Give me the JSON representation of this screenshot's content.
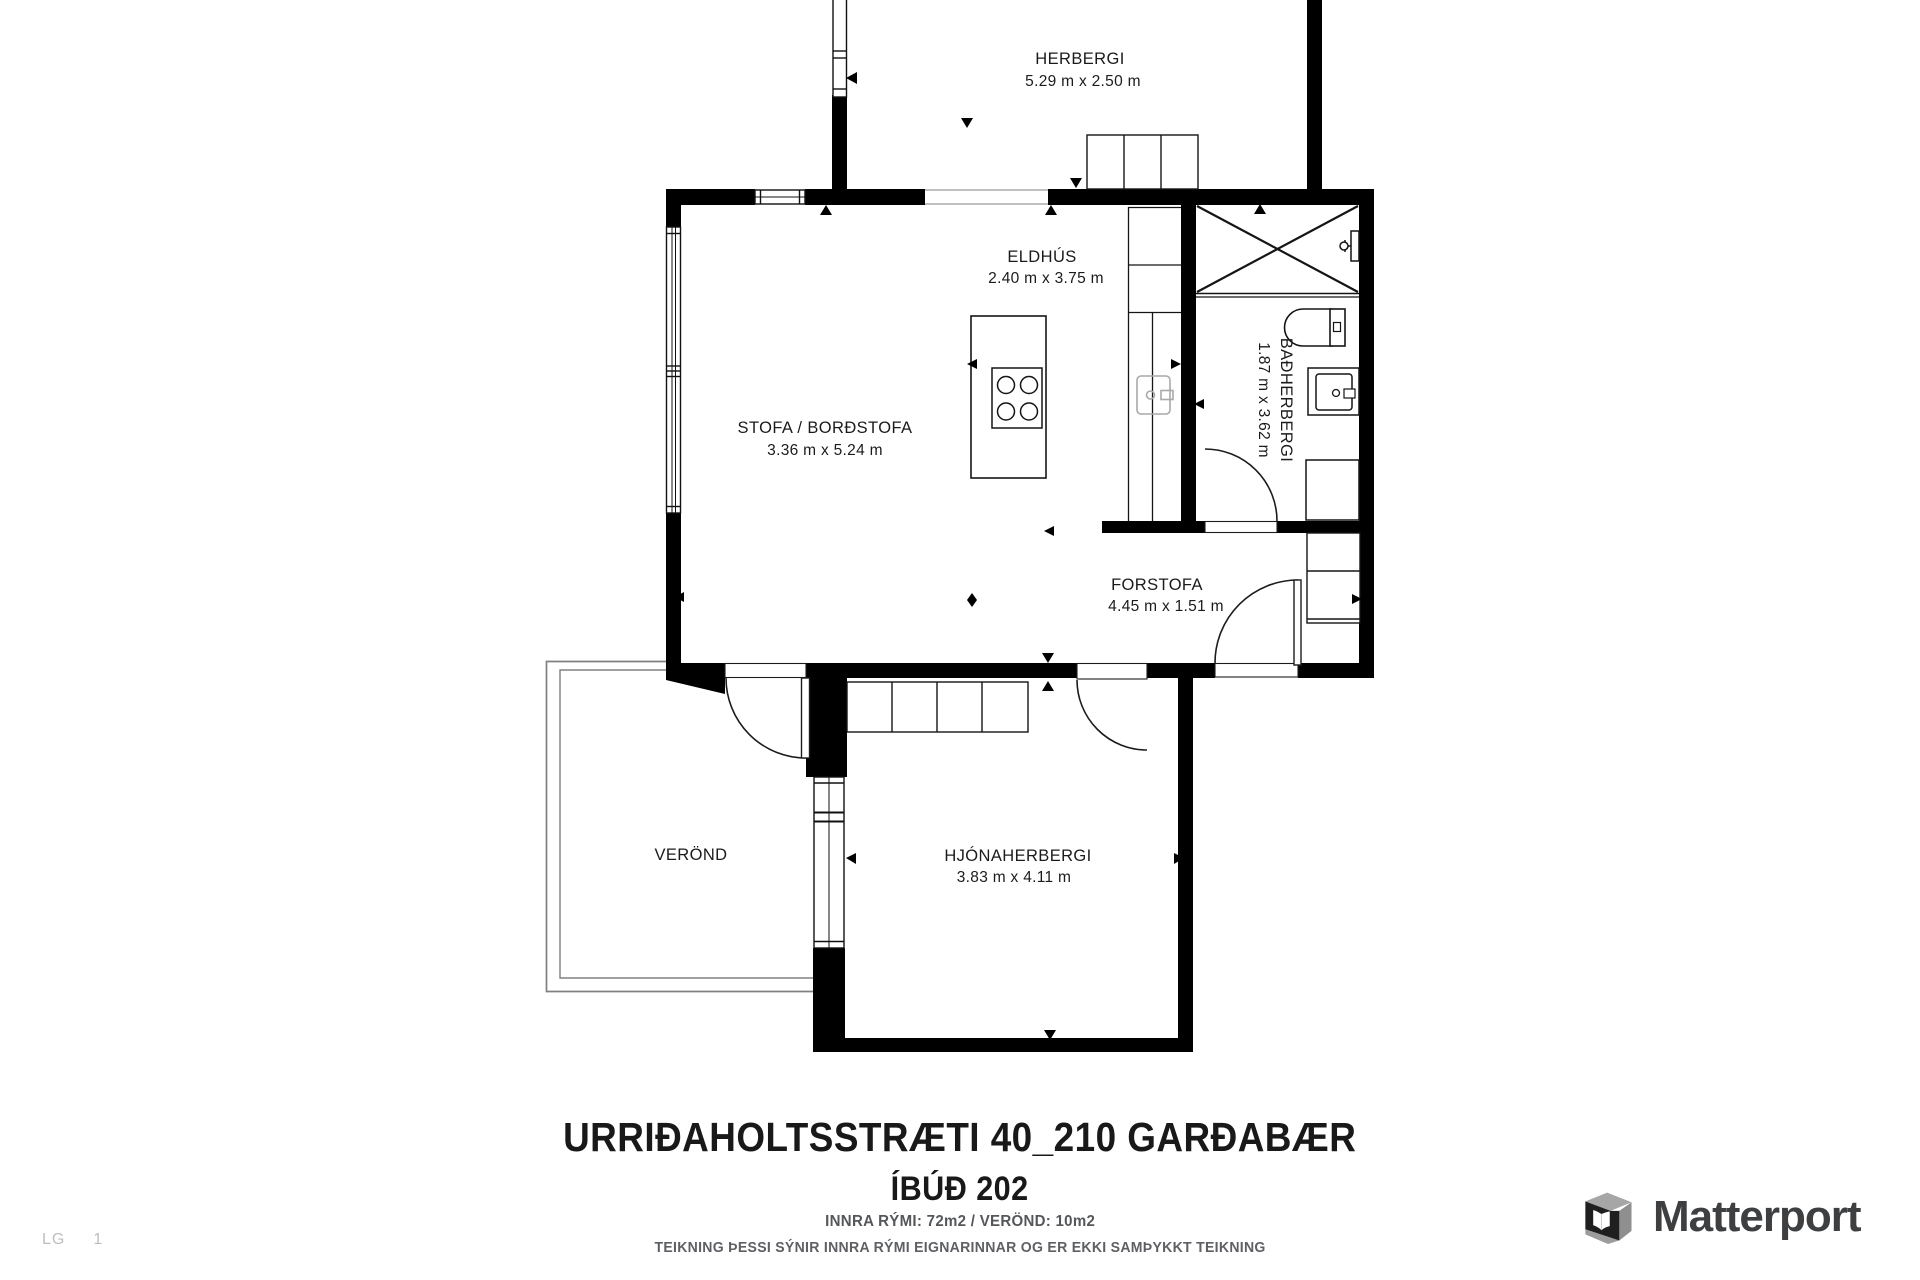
{
  "rooms": {
    "herbergi": {
      "name": "HERBERGI",
      "dims": "5.29 m x 2.50 m"
    },
    "eldhus": {
      "name": "ELDHÚS",
      "dims": "2.40 m x 3.75 m"
    },
    "stofa": {
      "name": "STOFA / BORÐSTOFA",
      "dims": "3.36 m x 5.24 m"
    },
    "badherbergi": {
      "name": "BAÐHERBERGI",
      "dims": "1.87 m x 3.62 m"
    },
    "forstofa": {
      "name": "FORSTOFA",
      "dims": "4.45 m x 1.51 m"
    },
    "hjonaherbergi": {
      "name": "HJÓNAHERBERGI",
      "dims": "3.83 m x 4.11 m"
    },
    "verond": {
      "name": "VERÖND"
    }
  },
  "title": {
    "address": "URRIÐAHOLTSSTRÆTI 40_210 GARÐABÆR",
    "unit": "ÍBÚÐ 202",
    "areas": "INNRA RÝMI: 72m2 / VERÖND: 10m2",
    "disclaimer": "TEIKNING ÞESSI SÝNIR INNRA RÝMI EIGNARINNAR OG ER EKKI SAMÞYKKT TEIKNING"
  },
  "watermark": {
    "left": "LG",
    "right": "1"
  },
  "branding": {
    "name": "Matterport"
  },
  "colors": {
    "wall": "#000000",
    "label": "#1b1b1b",
    "muted_text": "#55575b",
    "veranda_line": "#808080",
    "logo_text": "#3e3f41"
  }
}
